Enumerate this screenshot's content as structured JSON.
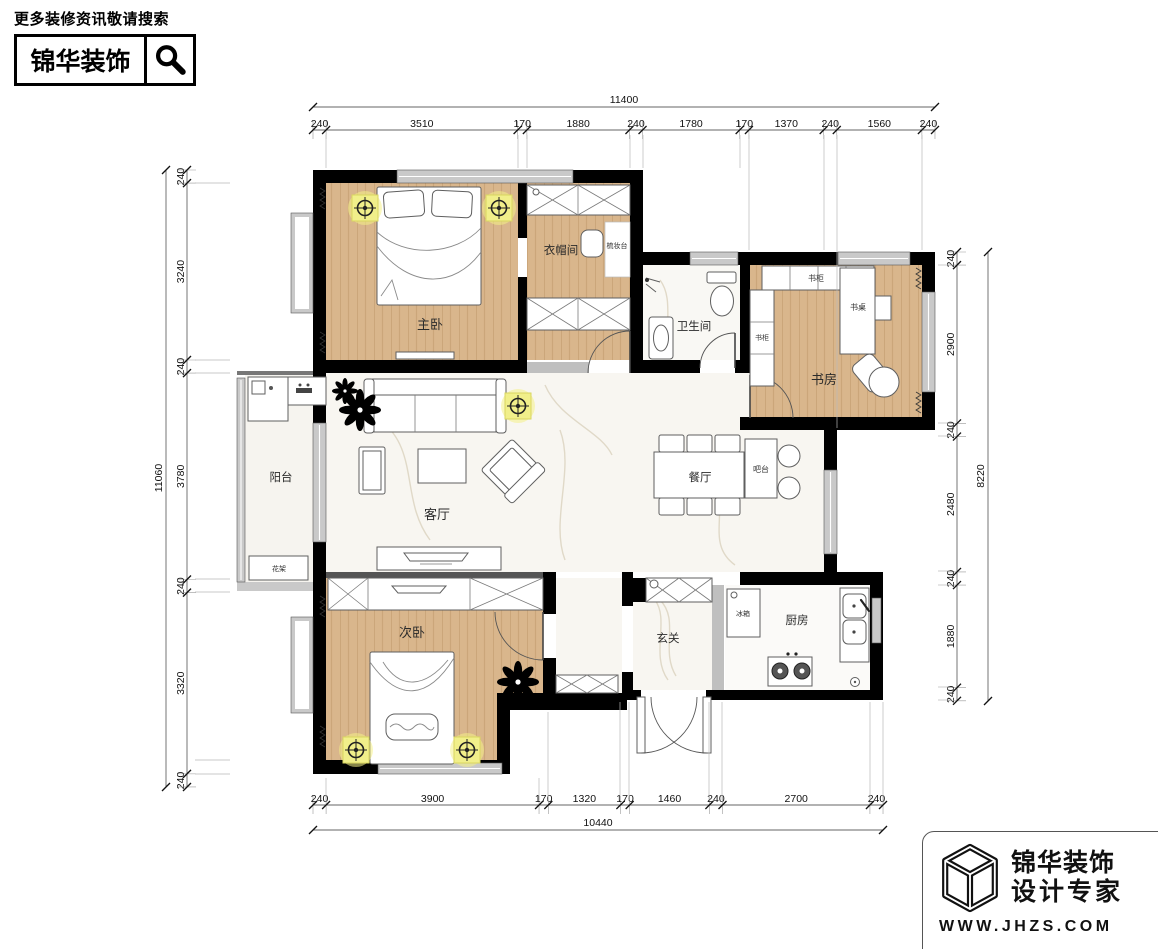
{
  "header": {
    "note": "更多装修资讯敬请搜索",
    "brand": "锦华装饰"
  },
  "rooms": {
    "master": "主卧",
    "cloak": "衣帽间",
    "dresser": "梳妆台",
    "bath": "卫生间",
    "study": "书房",
    "bookcase_top": "书柜",
    "bookcase_left": "书柜",
    "desk": "书桌",
    "balcony": "阳台",
    "flower_rack": "花架",
    "living": "客厅",
    "dining": "餐厅",
    "bar": "吧台",
    "bedroom2": "次卧",
    "entry": "玄关",
    "kitchen": "厨房",
    "fridge": "冰箱"
  },
  "dims": {
    "top": {
      "total": "11400",
      "segments": [
        "240",
        "3510",
        "170",
        "1880",
        "240",
        "1780",
        "170",
        "1370",
        "240",
        "1560",
        "240"
      ]
    },
    "bottom": {
      "total": "10440",
      "segments": [
        "240",
        "3900",
        "170",
        "1320",
        "170",
        "1460",
        "240",
        "2700",
        "240"
      ]
    },
    "left": {
      "total": "11060",
      "segments": [
        "240",
        "3240",
        "240",
        "3780",
        "240",
        "3320",
        "240"
      ]
    },
    "right": {
      "total": "8220",
      "segments": [
        "240",
        "2900",
        "240",
        "2480",
        "240",
        "1880",
        "240"
      ]
    }
  },
  "footer": {
    "brand": "锦华装饰",
    "tagline": "设计专家",
    "url": "WWW.JHZS.COM"
  },
  "colors": {
    "wall": "#000000",
    "wood": "#d9b68c",
    "marble": "#f8f6f1",
    "lamp_highlight": "#f1ef8a",
    "window_gray": "#c9c9c9"
  }
}
